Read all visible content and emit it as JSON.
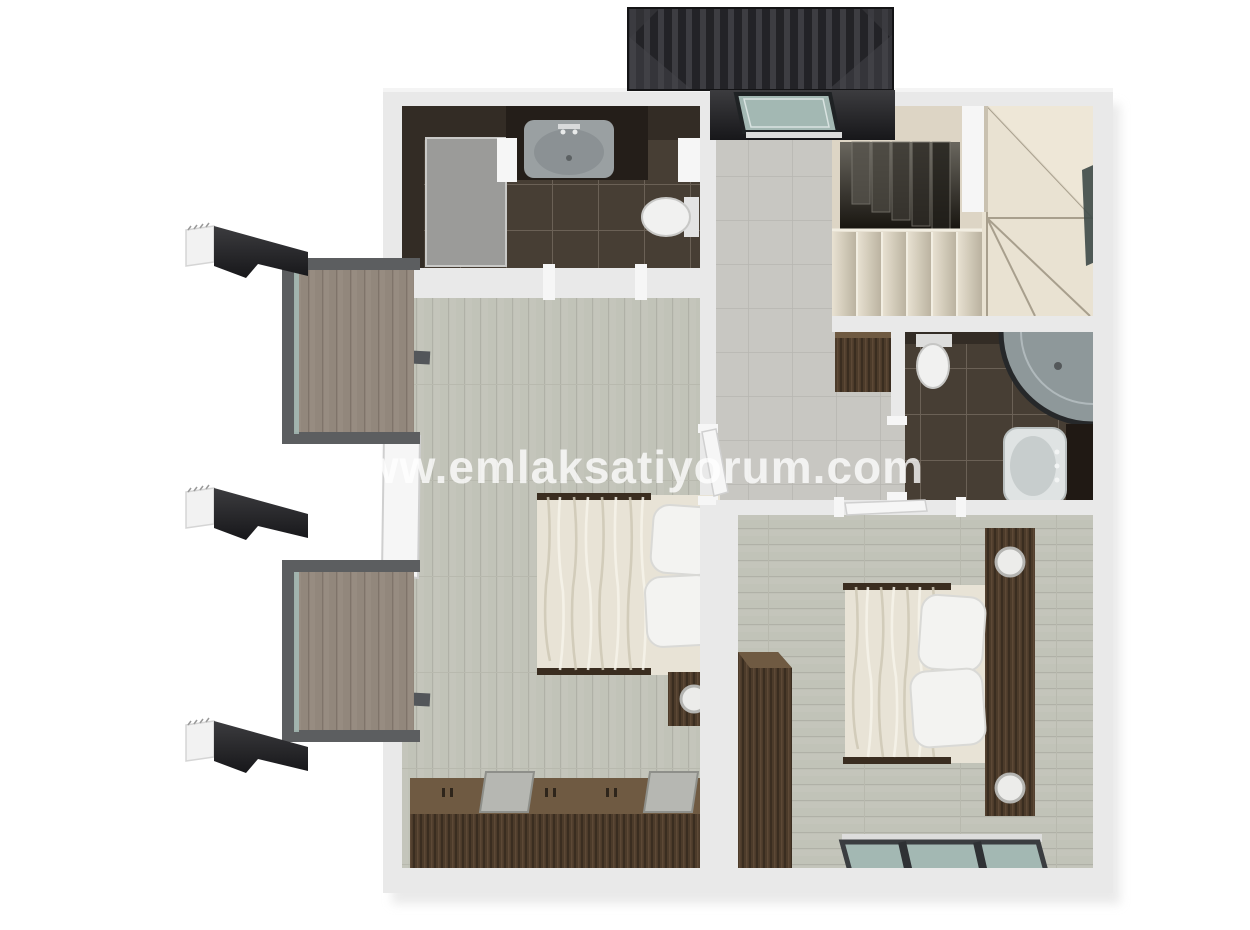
{
  "watermark": {
    "text": "www.emlaksatiyorum.com",
    "color": "#ffffff"
  },
  "scene": {
    "type": "3d-floor-plan-render",
    "view": "top-down"
  },
  "colors": {
    "wall": "#e9e9e9",
    "wallBright": "#f6f6f6",
    "wallShade": "#d2d2d2",
    "woodFloor": "#c4c5bb",
    "woodFloorLine": "#b0b1a7",
    "grayTile": "#c8c7c2",
    "grayTileLine": "#b7b6b1",
    "darkTile": "#473e34",
    "darkTileWall": "#332c25",
    "grout": "#6b6156",
    "walnut": "#4c3b2a",
    "walnutDark": "#3a2d20",
    "walnutLight": "#6f5a42",
    "stairCream": "#ddd5c5",
    "stairCreamLight": "#e9e2d2",
    "stairLine": "#a89f8d",
    "voidDark": "#17140f",
    "duvet": "#e8e3d6",
    "duvetShade": "#cfc8b6",
    "duvetLight": "#f7f4ea",
    "pillow": "#f3f3f1",
    "porcelain": "#f1f1f0",
    "chrome": "#9aa0a2",
    "glass": "#a3b8b3",
    "glassDark": "#3e4a48",
    "roof": "#232327",
    "roofStripe": "#3d3d42",
    "porch": "#28282b",
    "deck": "#978c81",
    "deckLine": "#7f746a",
    "frameGray": "#5c5e60",
    "showerFloor": "#9b9b99"
  }
}
